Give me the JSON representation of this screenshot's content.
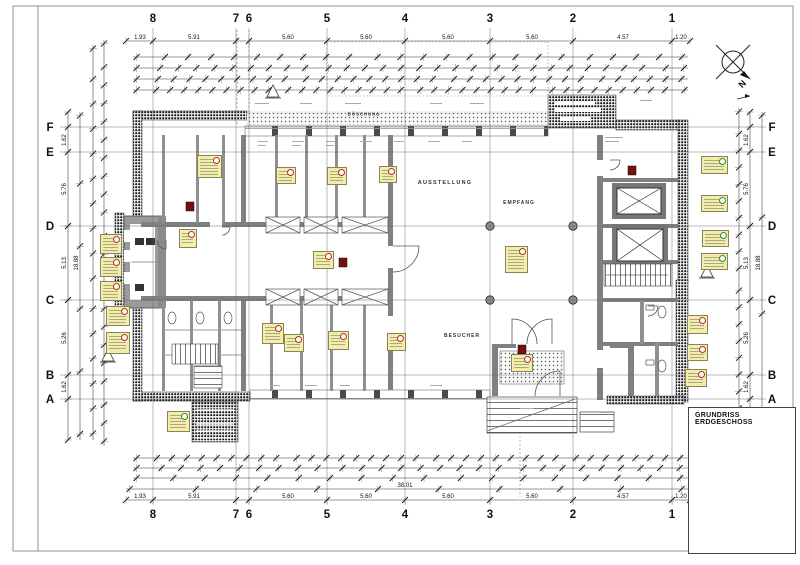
{
  "sheet": {
    "title": "GRUNDRISS ERDGESCHOSS"
  },
  "north": {
    "label": "N"
  },
  "rooms": [
    {
      "label": "AUSSTELLUNG",
      "x": 445,
      "y": 183,
      "fs": 5.5,
      "ls": 1.2
    },
    {
      "label": "EMPFANG",
      "x": 519,
      "y": 203,
      "fs": 5,
      "ls": 1
    },
    {
      "label": "BESUCHER",
      "x": 462,
      "y": 336,
      "fs": 5,
      "ls": 1
    },
    {
      "label": "BÖSCHUNG",
      "x": 364,
      "y": 114,
      "fs": 4.5,
      "ls": 0.8
    }
  ],
  "grid": {
    "cols": [
      {
        "label": "8",
        "x": 153
      },
      {
        "label": "7",
        "x": 236
      },
      {
        "label": "6",
        "x": 249
      },
      {
        "label": "5",
        "x": 327
      },
      {
        "label": "4",
        "x": 405
      },
      {
        "label": "3",
        "x": 490
      },
      {
        "label": "2",
        "x": 573
      },
      {
        "label": "1",
        "x": 672
      }
    ],
    "rows": [
      {
        "label": "F",
        "y": 127
      },
      {
        "label": "E",
        "y": 152
      },
      {
        "label": "D",
        "y": 226
      },
      {
        "label": "C",
        "y": 300
      },
      {
        "label": "B",
        "y": 375
      },
      {
        "label": "A",
        "y": 399
      }
    ],
    "top_label_y": 18,
    "bottom_label_y": 514,
    "left_label_x": 50,
    "right_label_x": 772,
    "line_top": 28,
    "line_bottom": 505,
    "line_left": 60,
    "line_right": 766
  },
  "dims": {
    "h": [
      {
        "y": 41,
        "x1": 126,
        "x2": 690,
        "ticks": "grid",
        "labels": [
          {
            "t": "1.93",
            "x": 140
          },
          {
            "t": "5.91",
            "x": 194
          },
          {
            "t": "5.60",
            "x": 288
          },
          {
            "t": "5.60",
            "x": 366
          },
          {
            "t": "5.60",
            "x": 448
          },
          {
            "t": "5.60",
            "x": 532
          },
          {
            "t": "4.57",
            "x": 623
          },
          {
            "t": "1.20",
            "x": 681
          }
        ]
      },
      {
        "y": 57,
        "x1": 133,
        "x2": 688,
        "n": 24
      },
      {
        "y": 68,
        "x1": 133,
        "x2": 688,
        "n": 30
      },
      {
        "y": 79,
        "x1": 133,
        "x2": 688,
        "n": 34
      },
      {
        "y": 90,
        "x1": 133,
        "x2": 688,
        "n": 38
      },
      {
        "y": 458,
        "x1": 133,
        "x2": 688,
        "n": 36
      },
      {
        "y": 468,
        "x1": 133,
        "x2": 688,
        "n": 28
      },
      {
        "y": 478,
        "x1": 133,
        "x2": 688,
        "n": 18
      },
      {
        "y": 489,
        "x1": 126,
        "x2": 690,
        "n": 10,
        "labels": [
          {
            "t": "38.01",
            "x": 405
          }
        ]
      },
      {
        "y": 500,
        "x1": 126,
        "x2": 690,
        "ticks": "grid",
        "labels": [
          {
            "t": "1.93",
            "x": 140
          },
          {
            "t": "5.91",
            "x": 194
          },
          {
            "t": "5.60",
            "x": 288
          },
          {
            "t": "5.60",
            "x": 366
          },
          {
            "t": "5.60",
            "x": 448
          },
          {
            "t": "5.60",
            "x": 532
          },
          {
            "t": "4.57",
            "x": 623
          },
          {
            "t": "1.20",
            "x": 681
          }
        ]
      }
    ],
    "v": [
      {
        "x": 68,
        "y1": 112,
        "y2": 440,
        "ticks": "rows",
        "labels": [
          {
            "t": "1.62",
            "y": 140
          },
          {
            "t": "5.76",
            "y": 189
          },
          {
            "t": "5.13",
            "y": 263
          },
          {
            "t": "5.26",
            "y": 338
          },
          {
            "t": "1.62",
            "y": 387
          }
        ]
      },
      {
        "x": 80,
        "y1": 112,
        "y2": 440,
        "n": 6,
        "labels": [
          {
            "t": "18.88",
            "y": 263
          }
        ]
      },
      {
        "x": 93,
        "y1": 45,
        "y2": 440,
        "n": 16
      },
      {
        "x": 104,
        "y1": 40,
        "y2": 446,
        "n": 22
      },
      {
        "x": 739,
        "y1": 108,
        "y2": 416,
        "n": 18
      },
      {
        "x": 750,
        "y1": 112,
        "y2": 415,
        "ticks": "rows",
        "labels": [
          {
            "t": "1.62",
            "y": 140
          },
          {
            "t": "5.76",
            "y": 189
          },
          {
            "t": "5.13",
            "y": 263
          },
          {
            "t": "5.26",
            "y": 338
          },
          {
            "t": "1.62",
            "y": 387
          }
        ]
      },
      {
        "x": 762,
        "y1": 112,
        "y2": 415,
        "n": 4,
        "labels": [
          {
            "t": "18.88",
            "y": 263
          }
        ]
      }
    ]
  },
  "tags": [
    {
      "x": 100,
      "y": 234,
      "w": 22,
      "h": 20,
      "c": "r"
    },
    {
      "x": 100,
      "y": 257,
      "w": 22,
      "h": 20,
      "c": "r"
    },
    {
      "x": 100,
      "y": 281,
      "w": 22,
      "h": 20,
      "c": "r"
    },
    {
      "x": 106,
      "y": 306,
      "w": 24,
      "h": 20,
      "c": "r"
    },
    {
      "x": 106,
      "y": 332,
      "w": 24,
      "h": 22,
      "c": "r"
    },
    {
      "x": 197,
      "y": 155,
      "w": 25,
      "h": 23,
      "c": "r"
    },
    {
      "x": 276,
      "y": 167,
      "w": 20,
      "h": 17,
      "c": "r"
    },
    {
      "x": 327,
      "y": 167,
      "w": 20,
      "h": 18,
      "c": "r"
    },
    {
      "x": 379,
      "y": 166,
      "w": 18,
      "h": 17,
      "c": "r"
    },
    {
      "x": 179,
      "y": 229,
      "w": 18,
      "h": 19,
      "c": "r"
    },
    {
      "x": 313,
      "y": 251,
      "w": 21,
      "h": 18,
      "c": "r"
    },
    {
      "x": 262,
      "y": 323,
      "w": 22,
      "h": 21,
      "c": "r"
    },
    {
      "x": 284,
      "y": 334,
      "w": 20,
      "h": 18,
      "c": "r"
    },
    {
      "x": 328,
      "y": 331,
      "w": 21,
      "h": 19,
      "c": "r"
    },
    {
      "x": 387,
      "y": 333,
      "w": 19,
      "h": 18,
      "c": "r"
    },
    {
      "x": 505,
      "y": 246,
      "w": 23,
      "h": 27,
      "c": "r"
    },
    {
      "x": 511,
      "y": 354,
      "w": 22,
      "h": 18,
      "c": "r"
    },
    {
      "x": 167,
      "y": 411,
      "w": 23,
      "h": 21,
      "c": "g"
    },
    {
      "x": 701,
      "y": 156,
      "w": 27,
      "h": 18,
      "c": "g"
    },
    {
      "x": 701,
      "y": 195,
      "w": 27,
      "h": 17,
      "c": "g"
    },
    {
      "x": 702,
      "y": 230,
      "w": 27,
      "h": 17,
      "c": "g"
    },
    {
      "x": 701,
      "y": 253,
      "w": 27,
      "h": 17,
      "c": "g"
    },
    {
      "x": 687,
      "y": 315,
      "w": 21,
      "h": 19,
      "c": "r"
    },
    {
      "x": 687,
      "y": 344,
      "w": 21,
      "h": 17,
      "c": "r"
    },
    {
      "x": 685,
      "y": 369,
      "w": 22,
      "h": 18,
      "c": "r"
    }
  ],
  "squares": [
    [
      190,
      206
    ],
    [
      343,
      262
    ],
    [
      522,
      349
    ],
    [
      632,
      170
    ]
  ],
  "triangles": [
    [
      108,
      356
    ],
    [
      273,
      92
    ],
    [
      707,
      272
    ]
  ],
  "colors": {
    "tag_fill": "#f2edae",
    "tag_red": "#b03030",
    "tag_green": "#2f8a35",
    "wall_dark": "#4a4a4a"
  }
}
